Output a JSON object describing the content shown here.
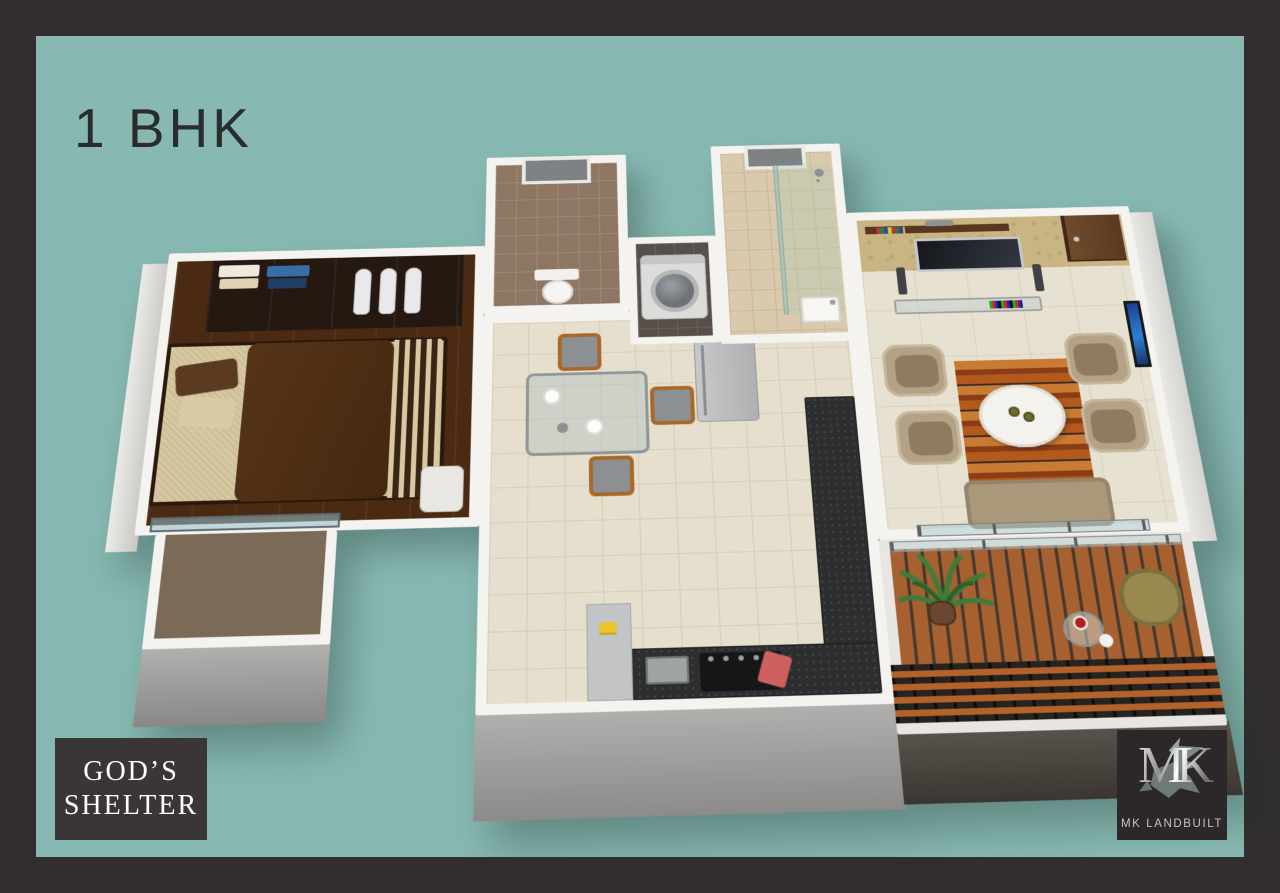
{
  "title": "1 BHK",
  "badge": {
    "line1": "GOD’S",
    "line2": "SHELTER"
  },
  "logo": {
    "monogram": "MK",
    "brand": "MK LANDBUILT"
  },
  "colors": {
    "teal": "#87b9b2",
    "frame": "#322e2f",
    "text_dark": "#2b2c2e",
    "wall": "#f4f3f0",
    "wood_floor": "#4a2a12",
    "tile": "#e6dfcd",
    "wallpaper": "#c9b583",
    "granite": "#2c2e2f",
    "deck": "#a7602f",
    "rug_orange": "#b4591c",
    "badge_bg": "#3a3637",
    "logo_bg": "#2c2829",
    "painting_blue": "#2f7fd0"
  },
  "plan": {
    "view": "3d-birdseye-floor-plan-render",
    "unit_type": "1 BHK",
    "rooms": [
      {
        "name": "bedroom",
        "features": [
          "double-bed",
          "brown-duvet",
          "striped-runner",
          "wardrobe-with-clothes",
          "hanging-garments",
          "corner-chair",
          "glass-balustrade",
          "private-balcony"
        ]
      },
      {
        "name": "toilet-bathroom",
        "features": [
          "brown-wall-tiles",
          "window",
          "toilet"
        ]
      },
      {
        "name": "utility-nook",
        "features": [
          "washing-machine",
          "dark-floor-tiles"
        ]
      },
      {
        "name": "shower-bathroom",
        "features": [
          "beige-wall-tiles",
          "window",
          "glass-shower-partition",
          "shower-head",
          "wash-basin"
        ]
      },
      {
        "name": "kitchen-dining",
        "features": [
          "u-shaped-granite-counter",
          "gas-hob",
          "red-chopping-board",
          "sink",
          "refrigerator",
          "glass-dining-table",
          "plates",
          "wood-frame-chairs"
        ]
      },
      {
        "name": "living-room",
        "features": [
          "patterned-wallpaper-wall",
          "wall-shelf-with-books",
          "soundbar",
          "wall-mounted-tv",
          "floor-speakers",
          "glass-media-console",
          "entry-door",
          "blue-wall-art",
          "four-tub-armchairs",
          "sofa",
          "round-coffee-table",
          "wood-striped-rug",
          "sliding-glass-door"
        ]
      },
      {
        "name": "balcony",
        "features": [
          "wood-plank-deck",
          "louvered-parapet",
          "potted-palm",
          "lounge-chair",
          "glass-side-table",
          "wine-glass",
          "plate"
        ]
      }
    ]
  }
}
